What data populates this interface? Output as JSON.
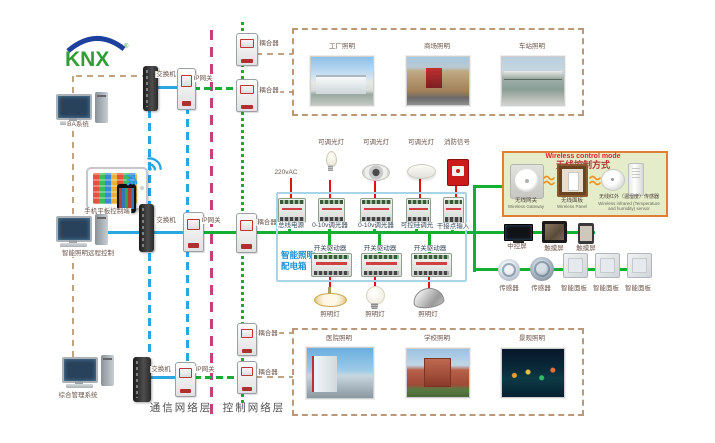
{
  "logo": {
    "brand": "KNX",
    "reg": "®"
  },
  "left": {
    "ba": "BA系统",
    "mobile": "手机平板控制端",
    "remote": "智能照明远程控制",
    "mgmt": "综合管理系统"
  },
  "net": {
    "switch": "交换机",
    "gateway": "IP网关",
    "coupler": "耦合器",
    "comm_layer": "通信网络层",
    "ctrl_layer": "控制网络层"
  },
  "top_photos": [
    "工厂照明",
    "商场照明",
    "车站照明"
  ],
  "bottom_photos": [
    "医院照明",
    "学校照明",
    "景观照明"
  ],
  "cab": {
    "t1": "智能照明",
    "t2": "配电箱",
    "pw": "220vAC",
    "mods_top": [
      "总线电源",
      "0-10v调光器",
      "0-10v调光器",
      "可控硅调光",
      "干接点输入"
    ],
    "loads_top": [
      "可调光灯",
      "可调光灯",
      "可调光灯",
      "消防信号"
    ],
    "mods_bot": [
      "开关驱动器",
      "开关驱动器",
      "开关驱动器"
    ],
    "loads_bot": [
      "照明灯",
      "照明灯",
      "照明灯"
    ]
  },
  "wifi": {
    "title_en": "Wireless control mode",
    "title_zh": "无线控制方式",
    "devices": [
      {
        "zh": "无线网关",
        "en": "Wireless Gateway"
      },
      {
        "zh": "无线面板",
        "en": "Wireless Panel"
      },
      {
        "zh": "无线红外（温湿度）传感器",
        "en": "Wireless infrared (Temperature and humidity) sensor"
      }
    ]
  },
  "right": {
    "screens": [
      "中控屏",
      "触摸屏",
      "触摸屏"
    ],
    "field": [
      "传感器",
      "传感器",
      "智能面板",
      "智能面板",
      "智能面板"
    ]
  },
  "colors": {
    "bus_green": "#14ae35",
    "lan_blue": "#2aa7e0",
    "power_red": "#e01212",
    "backbone_pink": "#c2437c",
    "mgmt_tan": "#c2a482",
    "cabinet_border": "#a8d4e8",
    "wireless_border": "#e08030",
    "knx_green": "#2f9e36",
    "knx_blue": "#1d3f9e"
  }
}
